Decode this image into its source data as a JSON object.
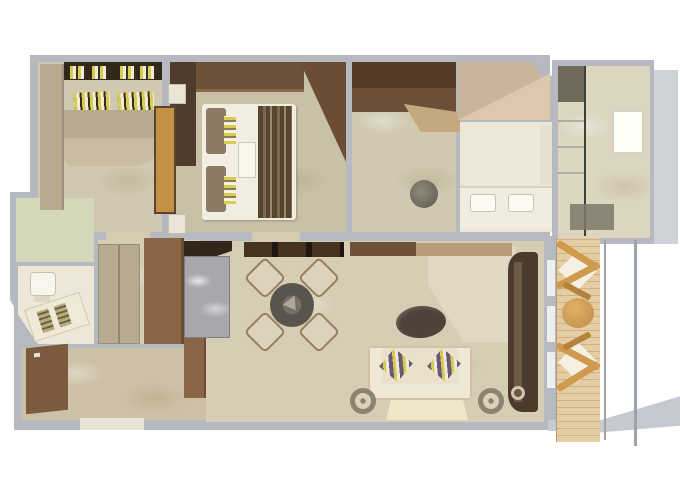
{
  "plan": {
    "type": "floor-plan",
    "rooms": [
      "second-bedroom",
      "master-bedroom",
      "walk-in-closet",
      "master-bathroom",
      "shower-room",
      "guest-bathroom",
      "corridor-closets",
      "entry-hall",
      "dining-area",
      "living-area",
      "balcony"
    ]
  },
  "palette": {
    "bg": "#ffffff",
    "wall": "#b6bac0",
    "wall_light": "#ced2d6",
    "wall_dark": "#9ea3a9",
    "slab": "#c6cad0",
    "floor": "#d6cdb5",
    "floor_dark": "#ccc1a6",
    "floor_light": "#e0d8c2",
    "floor_pale": "#ece7d7",
    "floor_green": "#d5d7ba",
    "floor_marble": "#d0c8b0",
    "floor_bedroom": "#c9c0a8",
    "floor_shower": "#dcd5c0",
    "wood_darkest": "#33271c",
    "wood_dark": "#46331f",
    "wood_mid": "#8a6647",
    "wood_light": "#b6aa90",
    "wood_pale": "#c5a87e",
    "bed_white": "#f1ede1",
    "runner": "#57452f",
    "gold": "#c49044",
    "granite": "#a8a8ac",
    "table_dark": "#5a554c",
    "sofa": "#e9e1cc",
    "pillow_purple": "#6a5878",
    "pillow_yellow": "#d8cc50",
    "deck": "#e4cda2",
    "deck_line": "#b99a6e",
    "chair_wood": "#cf9a4e",
    "rug": "#efe5c8",
    "glass": "#3f3e39",
    "mat": "#7d7869",
    "tub": "#c9b59c",
    "tub_light": "#dcc9ad"
  }
}
